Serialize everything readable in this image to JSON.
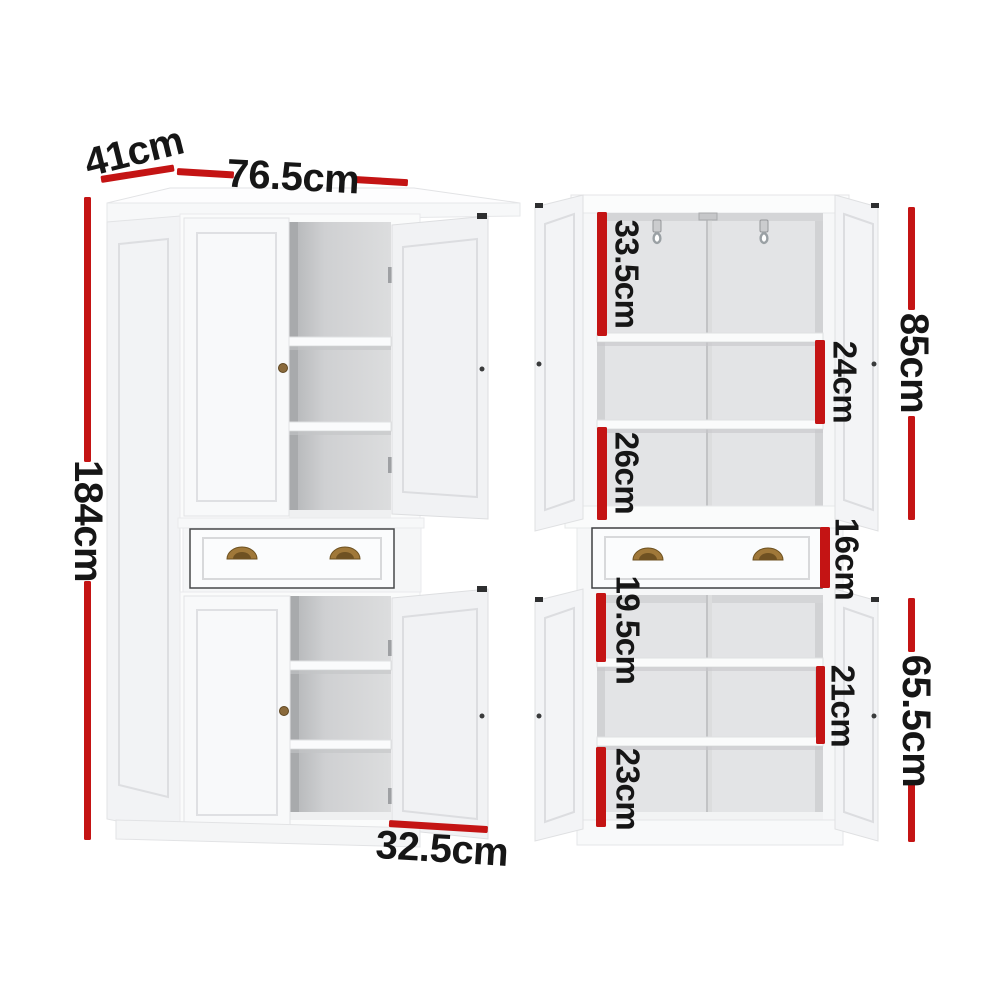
{
  "diagram": {
    "kind": "furniture-dimension-diagram",
    "subject": "white pantry cupboard shown in two views (closed perspective view and open front view)",
    "unit": "cm"
  },
  "dimensions": {
    "depth": "41cm",
    "width": "76.5cm",
    "height": "184cm",
    "bottom_internal_width": "32.5cm",
    "upper_top_compartment": "33.5cm",
    "upper_middle_compartment": "24cm",
    "upper_bottom_compartment": "26cm",
    "upper_section_height": "85cm",
    "drawer_height": "16cm",
    "lower_top_compartment": "19.5cm",
    "lower_middle_compartment": "21cm",
    "lower_bottom_compartment": "23cm",
    "lower_section_height": "65.5cm"
  },
  "colors": {
    "dimension_marker": "#c41414",
    "label_text": "#161616",
    "background": "#ffffff"
  }
}
